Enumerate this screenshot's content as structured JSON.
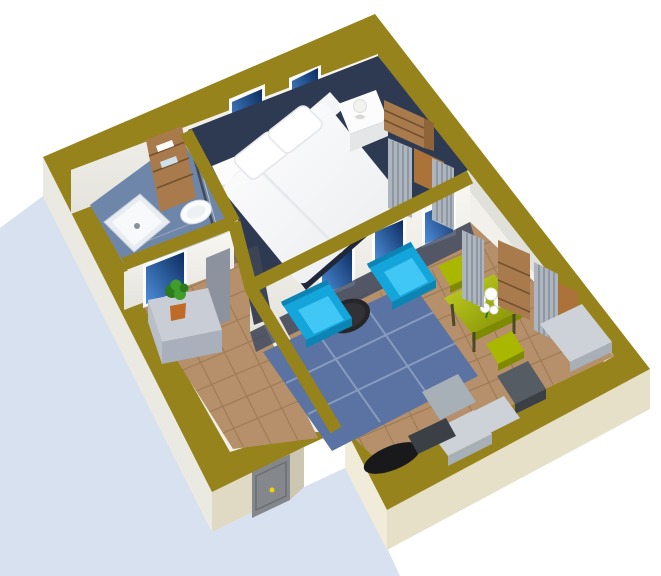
{
  "scene": {
    "title": "3D isometric floor plan render of a one-bedroom apartment",
    "type": "architectural-3d-render",
    "text_content": "none",
    "view": "rotated top-down perspective, olive wall tops, white background, light blue ground shadow"
  },
  "palette": {
    "shadow": "#d7e1ef",
    "wall_top": "#97831b",
    "base": "#f1f0ea",
    "ne_sliver": "#e1e1db",
    "wall_face": "#f6f5f0",
    "wall_face_dim": "#e8e7e1",
    "ext_sw": "#ebeae2",
    "ext_hall_se": "#e0d9c3",
    "ext_recess": "#cdc7b2",
    "ext_living_sw": "#f1ecd9",
    "ext_se": "#e7e0c9",
    "door": "#84878c",
    "door_dark": "#6b6e73",
    "knob": "#f2d200",
    "frame": "#fbfbfb",
    "glass_light": "#4f8fdc",
    "glass_dark": "#0b2c5e",
    "bath_floor": "#6e86aa",
    "carpet": "#2e3952",
    "floor_tan": "#b5906a",
    "grout": "#8a6844",
    "wood_floor": "#ab7239",
    "rug": "#5a73a2",
    "rug_line": "#8fa2c4",
    "shadow_strip": "#3b4764",
    "cyan": "#14a5da",
    "cyan_light": "#41c7f5",
    "cyan_dark": "#0c84b4",
    "coffee": "#26262a",
    "table": "#a9b700",
    "table_light": "#c6d426",
    "table_dark": "#7e8a00",
    "wood": "#a87a4c",
    "wood_mid": "#8f6438",
    "wood_dark": "#73512e",
    "gray_top": "#ccd2d8",
    "gray_front": "#a7afb7",
    "unit_dark": "#565c64",
    "unit_darker": "#3a4046",
    "black": "#19191c",
    "curtain": "#adb5bf",
    "curtain_stripe": "#8b939e",
    "white": "#fcfcfd",
    "bed_fold": "#e2e5ea",
    "under_bed": "#1f2738",
    "cabinet": "#c9ced6",
    "cabinet_front": "#a9b0bb",
    "cabinet_side": "#b8bfc9",
    "plant": "#3f9e2a",
    "plant_dark": "#2e7a1e",
    "pot": "#c06a28",
    "door_leaf": "#3d4454",
    "door_panel": "#8d939e",
    "shower": "#e9edf1",
    "shower_inner": "#f7f9fb",
    "drain": "#8a929c",
    "sink": "#fbfcfd",
    "lamp": "#f2f2ee",
    "glass_screen": "#3a4048"
  },
  "rooms": {
    "bathroom": {
      "label": "Bathroom",
      "items": [
        "shower-tray",
        "shelf-unit",
        "towels",
        "washbasin",
        "shower-screen"
      ]
    },
    "bedroom": {
      "label": "Bedroom",
      "items": [
        "double-bed",
        "pillow",
        "pillow",
        "nightstand-left",
        "nightstand-right",
        "table-lamp",
        "wardrobe",
        "window",
        "window",
        "curtain",
        "curtain",
        "open-door"
      ]
    },
    "hallway": {
      "label": "Hallway",
      "items": [
        "sideboard",
        "potted-plant",
        "window",
        "door-panel",
        "front-door"
      ]
    },
    "living_room": {
      "label": "Living room / kitchen",
      "items": [
        "armchair",
        "armchair",
        "coffee-table",
        "area-rug",
        "dining-table",
        "flower-bouquet",
        "bench",
        "stool",
        "window",
        "window",
        "window",
        "curtain",
        "curtain",
        "ladder-shelf",
        "kitchen-counter",
        "kitchen-counter",
        "media-unit",
        "gray-sofa",
        "desk-chair"
      ]
    }
  }
}
